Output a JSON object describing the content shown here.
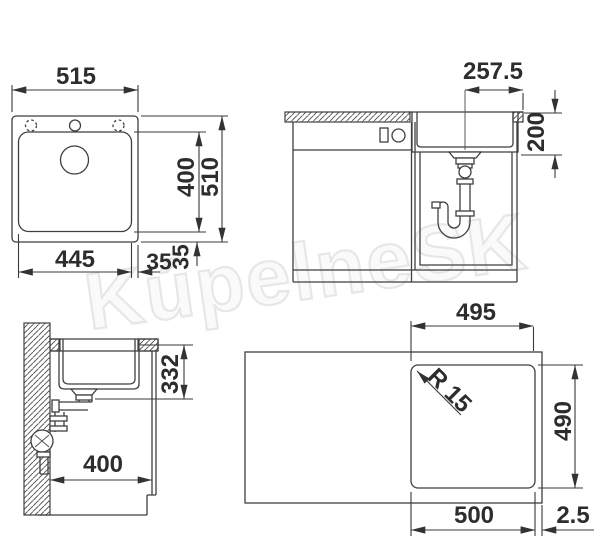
{
  "watermark_text": "KúpelneSK",
  "colors": {
    "line": "#3f3f3f",
    "dimension_text": "#2d2d2d",
    "watermark_outline": "#e7e7e7",
    "background": "#ffffff"
  },
  "dims": {
    "sink_top_view": {
      "overall_width": "515",
      "overall_depth": "510",
      "basin_depth": "400",
      "basin_width": "445",
      "side_margin": "35",
      "bottom_margin": "35"
    },
    "front_section_view": {
      "drain_center_offset": "257.5",
      "bowl_depth": "200"
    },
    "side_section_view": {
      "drain_outlet_height": "332",
      "wall_clearance": "400"
    },
    "cutout_view": {
      "top_width": "495",
      "depth": "490",
      "bottom_width": "500",
      "edge_distance": "2.5",
      "corner_radius": "R 15"
    }
  }
}
